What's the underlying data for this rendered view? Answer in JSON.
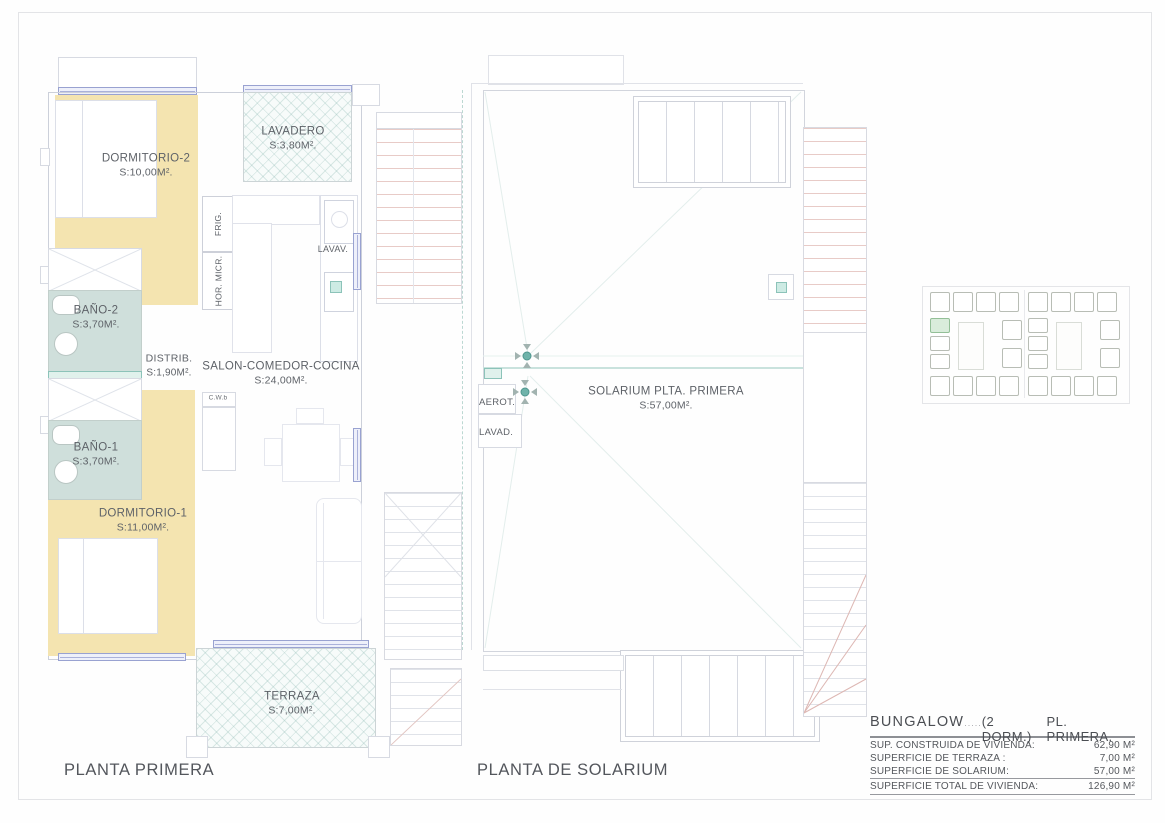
{
  "planta_primera": {
    "title": "PLANTA PRIMERA",
    "rooms": [
      {
        "id": "dormitorio-2",
        "name": "DORMITORIO-2",
        "area": "S:10,00M²."
      },
      {
        "id": "lavadero",
        "name": "LAVADERO",
        "area": "S:3,80M²."
      },
      {
        "id": "bano-2",
        "name": "BAÑO-2",
        "area": "S:3,70M²."
      },
      {
        "id": "distribuidor",
        "name": "DISTRIB.",
        "area": "S:1,90M²."
      },
      {
        "id": "salon-comedor-cocina",
        "name": "SALON-COMEDOR-COCINA",
        "area": "S:24,00M²."
      },
      {
        "id": "bano-1",
        "name": "BAÑO-1",
        "area": "S:3,70M²."
      },
      {
        "id": "dormitorio-1",
        "name": "DORMITORIO-1",
        "area": "S:11,00M²."
      },
      {
        "id": "terraza",
        "name": "TERRAZA",
        "area": "S:7,00M²."
      }
    ],
    "labels": {
      "frig": "FRIG.",
      "hor_micr": "HOR. MICR.",
      "lavav": "LAVAV.",
      "cw": "C.W.b"
    }
  },
  "planta_solarium": {
    "title": "PLANTA DE SOLARIUM",
    "room": {
      "name": "SOLARIUM PLTA. PRIMERA",
      "area": "S:57,00M²."
    },
    "labels": {
      "aerot": "AEROT.",
      "lavad": "LAVAD."
    }
  },
  "spec_table": {
    "product": "BUNGALOW",
    "dots": ".....",
    "variant": "(2 DORM.)",
    "floor": "PL. PRIMERA.",
    "rows": [
      {
        "label": "SUP. CONSTRUIDA DE VIVIENDA:",
        "value": "62,90 M²"
      },
      {
        "label": "SUPERFICIE DE TERRAZA :",
        "value": "7,00 M²"
      },
      {
        "label": "SUPERFICIE  DE SOLARIUM:",
        "value": "57,00 M²"
      },
      {
        "label": "SUPERFICIE  TOTAL DE VIVIENDA:",
        "value": "126,90 M²"
      }
    ]
  },
  "icons": {
    "roof_vent_icon": "four gray arrows converging on teal circle"
  },
  "palette": {
    "bedroom_fill": "#f4e4b0",
    "bath_fill": "#cfdfdb",
    "hatch_tint": "#8cb9b2",
    "window_blue": "#99a2d1",
    "accent_teal": "#6fb3aa",
    "stair_red": "#e8cbc7",
    "highlight_unit_green": "#d9ecdb"
  }
}
